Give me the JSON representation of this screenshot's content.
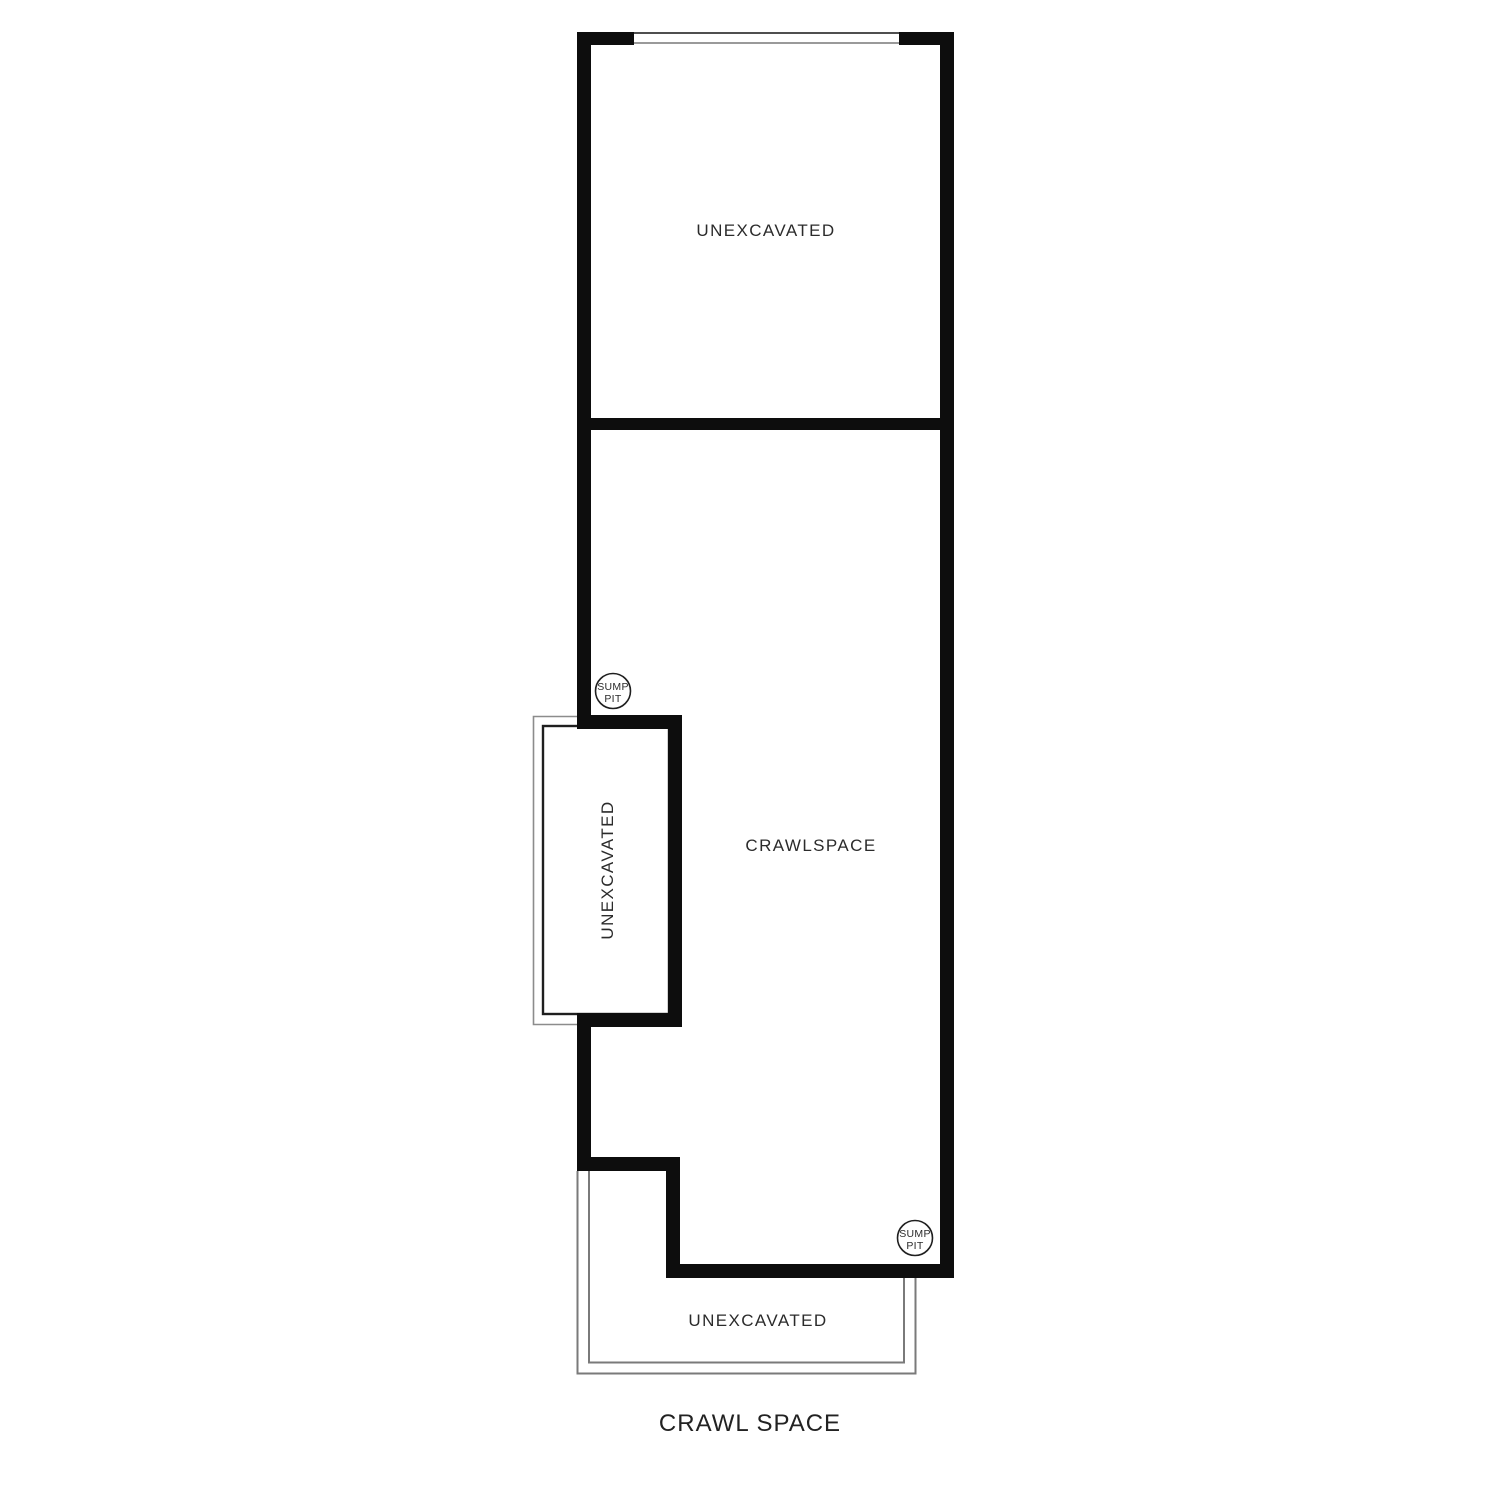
{
  "drawing": {
    "title": "CRAWL SPACE",
    "rooms": {
      "top_unexcavated": "UNEXCAVATED",
      "crawlspace": "CRAWLSPACE",
      "left_bay_unexcavated": "UNEXCAVATED",
      "bottom_unexcavated": "UNEXCAVATED"
    },
    "sump_pit": {
      "line1": "SUMP",
      "line2": "PIT"
    },
    "colors": {
      "wall": "#0d0d0d",
      "thin_line": "#8c8c8c",
      "porch_line": "#7a7a7a",
      "text": "#2b2b2b",
      "background": "#ffffff"
    }
  }
}
